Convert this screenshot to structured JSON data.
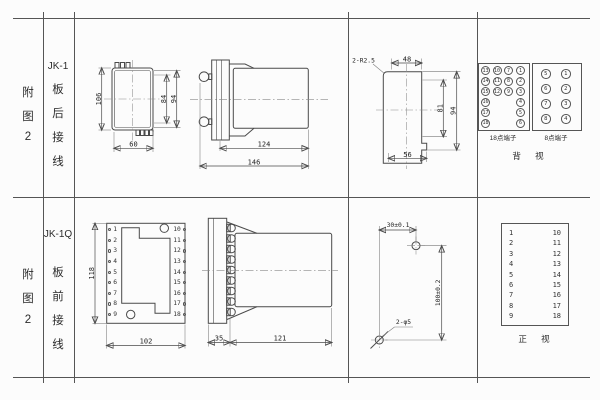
{
  "page": {
    "background": "#fcfcfc",
    "line_color": "#555555",
    "text_color": "#2b2b2b"
  },
  "row1": {
    "fig": [
      "附",
      "图",
      "2"
    ],
    "model": "JK-1",
    "wiring": [
      "板",
      "后",
      "接",
      "线"
    ],
    "rear_view": {
      "height": "106",
      "inner_height": "84",
      "outer_height": "94",
      "width": "60"
    },
    "side_view": {
      "body_length": "124",
      "total_length": "146"
    },
    "cutout": {
      "corner_radius": "2-R2.5",
      "top_width": "48",
      "inner_height": "81",
      "outer_height": "94",
      "bottom_width": "56"
    },
    "t18": {
      "label": "18点端子",
      "col1": [
        "13",
        "14",
        "15",
        "16",
        "17",
        "18"
      ],
      "col2": [
        "10",
        "11",
        "12"
      ],
      "col3": [
        "7",
        "8",
        "9"
      ],
      "col4": [
        "1",
        "2",
        "3",
        "4",
        "5",
        "6"
      ]
    },
    "t8": {
      "label": "8点端子",
      "left": [
        "5",
        "6",
        "7",
        "8"
      ],
      "right": [
        "1",
        "2",
        "3",
        "4"
      ]
    },
    "view_label": "背 视"
  },
  "row2": {
    "fig": [
      "附",
      "图",
      "2"
    ],
    "model": "JK-1Q",
    "wiring": [
      "板",
      "前",
      "接",
      "线"
    ],
    "front_view": {
      "height": "118",
      "width": "102",
      "left_terminals": [
        "1",
        "2",
        "3",
        "4",
        "5",
        "6",
        "7",
        "8",
        "9"
      ],
      "right_terminals": [
        "10",
        "11",
        "12",
        "13",
        "14",
        "15",
        "16",
        "17",
        "18"
      ]
    },
    "side_view": {
      "plate": "35",
      "body_length": "121"
    },
    "drill": {
      "h_span": "30±0.1",
      "v_span": "100±0.2",
      "holes": "2-φ5"
    },
    "table": {
      "left": [
        "1",
        "2",
        "3",
        "4",
        "5",
        "6",
        "7",
        "8",
        "9"
      ],
      "right": [
        "10",
        "11",
        "12",
        "13",
        "14",
        "15",
        "16",
        "17",
        "18"
      ]
    },
    "view_label": "正 视"
  }
}
